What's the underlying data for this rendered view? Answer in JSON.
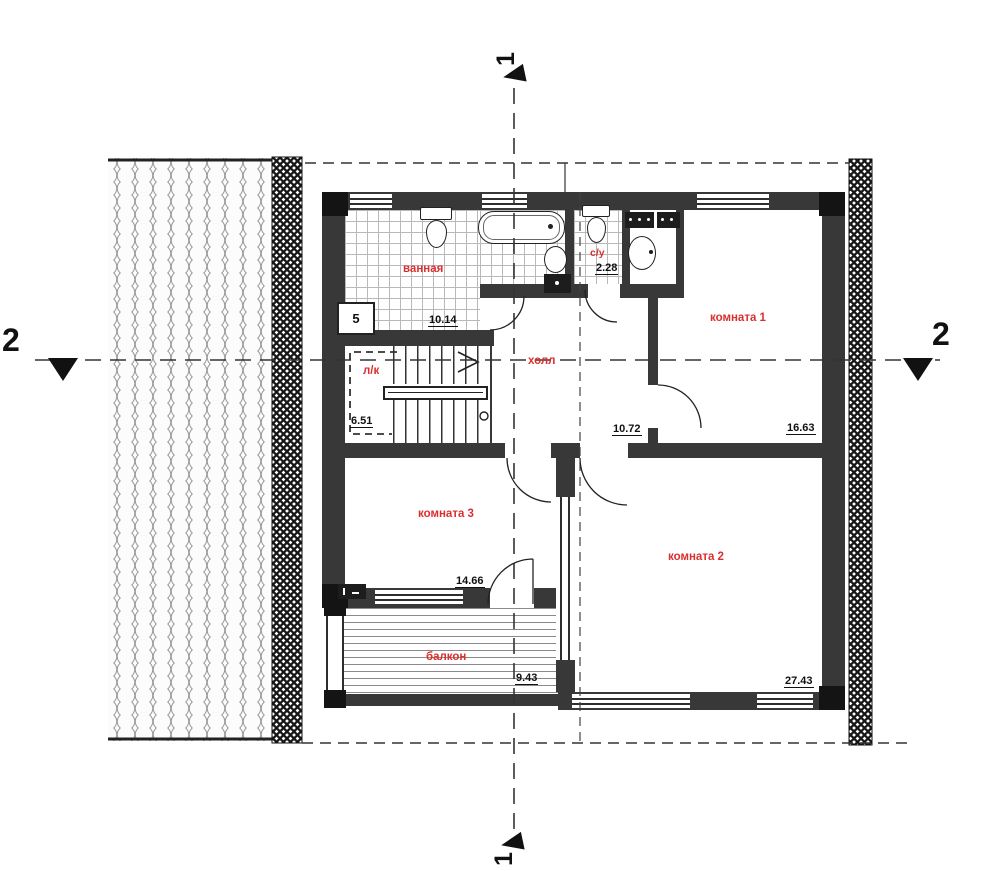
{
  "rooms": {
    "bathroom": {
      "label": "ванная",
      "area": "10.14"
    },
    "wc": {
      "label": "с/у",
      "area": "2.28"
    },
    "room1": {
      "label": "комната 1",
      "area": "16.63"
    },
    "hall": {
      "label": "холл",
      "area": "10.72"
    },
    "stairs": {
      "label": "л/к",
      "area": "6.51"
    },
    "room3": {
      "label": "комната 3",
      "area": "14.66"
    },
    "room2": {
      "label": "комната 2",
      "area": "27.43"
    },
    "balcony": {
      "label": "балкон",
      "area": "9.43"
    }
  },
  "markers": {
    "section1_top": "1",
    "section1_bottom": "1",
    "section2_left": "2",
    "section2_right": "2",
    "equipment_tag": "5"
  },
  "colors": {
    "room_label": "#d93030",
    "wall": "#383838",
    "dash": "#333333"
  }
}
